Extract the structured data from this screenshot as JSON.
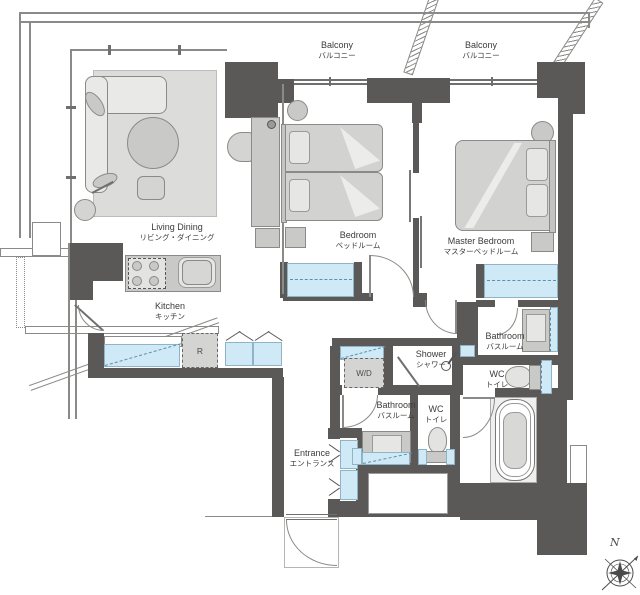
{
  "plan": {
    "rooms": {
      "living_dining": {
        "en": "Living Dining",
        "jp": "リビング・ダイニング"
      },
      "kitchen": {
        "en": "Kitchen",
        "jp": "キッチン"
      },
      "bedroom": {
        "en": "Bedroom",
        "jp": "ベッドルーム"
      },
      "master_bedroom": {
        "en": "Master Bedroom",
        "jp": "マスターベッドルーム"
      },
      "balcony_left": {
        "en": "Balcony",
        "jp": "バルコニー"
      },
      "balcony_right": {
        "en": "Balcony",
        "jp": "バルコニー"
      },
      "bathroom_main": {
        "en": "Bathroom",
        "jp": "バスルーム"
      },
      "bathroom_ensuite": {
        "en": "Bathroom",
        "jp": "バスルーム"
      },
      "wc_main": {
        "en": "WC",
        "jp": "トイレ"
      },
      "wc_ensuite": {
        "en": "WC",
        "jp": "トイレ"
      },
      "shower": {
        "en": "Shower",
        "jp": "シャワー"
      },
      "entrance": {
        "en": "Entrance",
        "jp": "エントランス"
      }
    },
    "features": {
      "washer_dryer": "W/D",
      "refrigerator": "R",
      "compass_north": "N"
    },
    "colors": {
      "wall": "#5b5958",
      "outline": "#8a8a88",
      "closet": "#cfe9f7",
      "closet_border": "#8fb3c7",
      "closet_dash": "#5d8fae",
      "furniture": "#d4d4d2",
      "furniture_dark": "#c9c9c7",
      "rug": "#dcdcda",
      "label": "#3b3b3b"
    }
  }
}
